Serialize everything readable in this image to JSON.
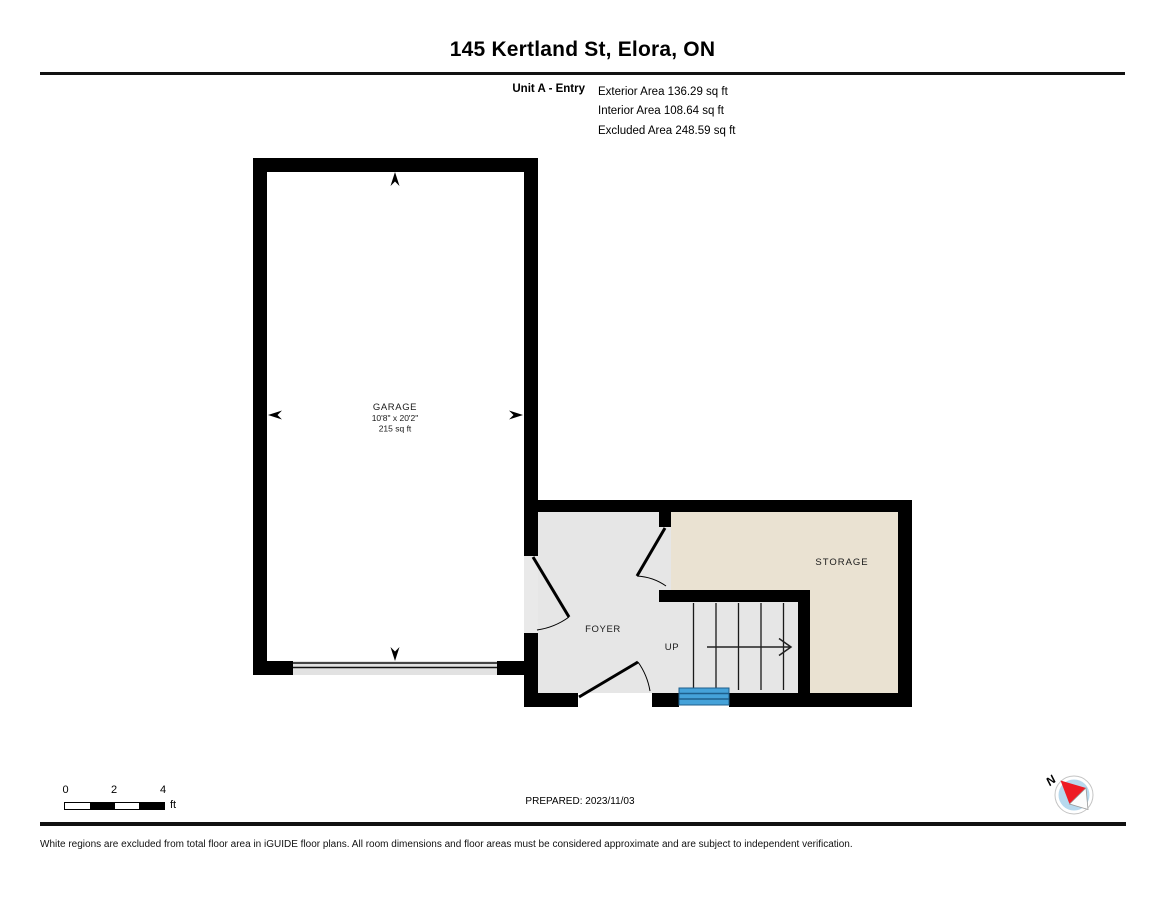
{
  "header": {
    "title": "145 Kertland St, Elora, ON",
    "unit_label": "Unit A - Entry",
    "area_lines": [
      "Exterior Area 136.29 sq ft",
      "Interior Area 108.64 sq ft",
      "Excluded Area 248.59 sq ft"
    ]
  },
  "floor_plan": {
    "rooms": {
      "garage": {
        "name": "GARAGE",
        "dimensions": "10'8\" x 20'2\"",
        "area": "215 sq ft"
      },
      "foyer": {
        "name": "FOYER"
      },
      "storage": {
        "name": "STORAGE"
      }
    },
    "stairs": {
      "direction_label": "UP"
    },
    "colors": {
      "wall": "#000000",
      "foyer_fill": "#e6e6e6",
      "storage_fill": "#eae2d2",
      "doorway_fill": "#e9e9e9",
      "garage_door_fill": "#e2e2e2",
      "stair_highlight": "#45a2d9",
      "stair_highlight_dark": "#1e5f8c",
      "compass_fill": "#b7d9ee",
      "compass_needle_red": "#ee1c25"
    }
  },
  "footer": {
    "scale_bar": {
      "ticks": [
        "0",
        "2",
        "4"
      ],
      "unit": "ft"
    },
    "prepared_label": "PREPARED: 2023/11/03",
    "compass_north_label": "N",
    "disclaimer": "White regions are excluded from total floor area in iGUIDE floor plans. All room dimensions and floor areas must be considered approximate and are subject to independent verification."
  }
}
